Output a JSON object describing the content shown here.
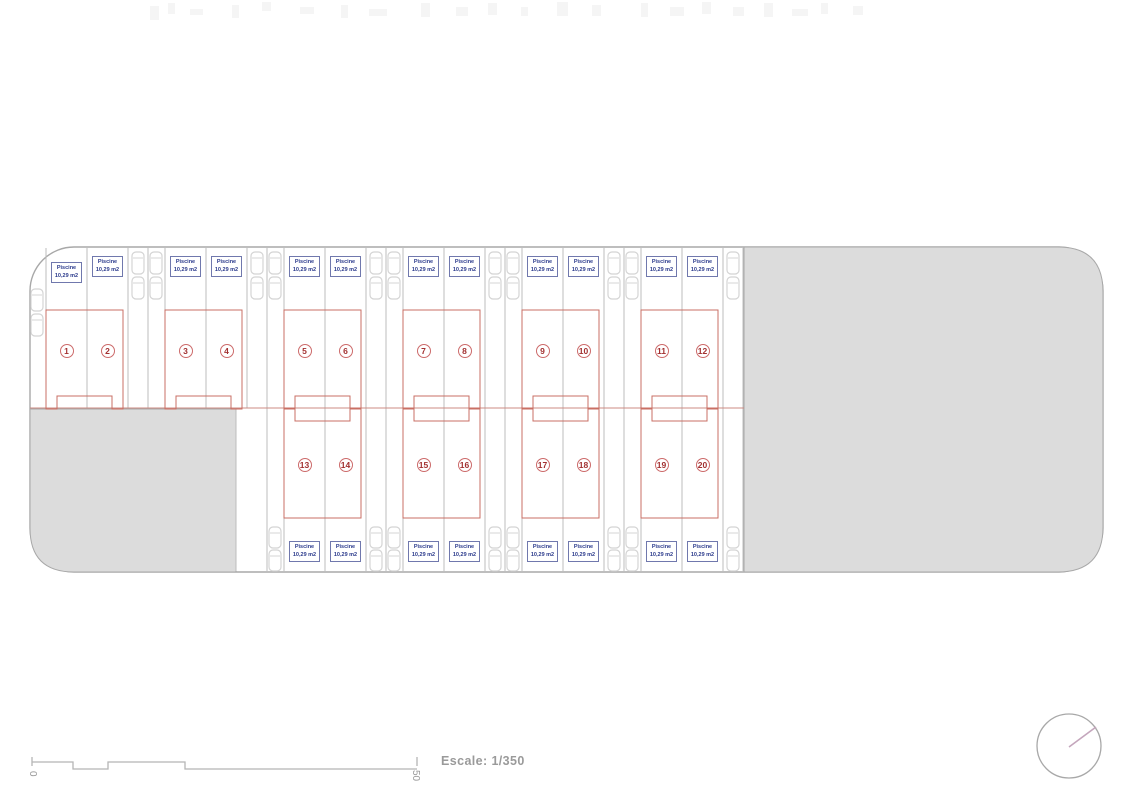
{
  "plan": {
    "unit_numbers": [
      "1",
      "2",
      "3",
      "4",
      "5",
      "6",
      "7",
      "8",
      "9",
      "10",
      "11",
      "12",
      "13",
      "14",
      "15",
      "16",
      "17",
      "18",
      "19",
      "20"
    ],
    "pool_label": {
      "line1": "Piscine",
      "line2": "10,29 m2"
    },
    "scale": {
      "text": "Escale: 1/350",
      "start_label": "0",
      "end_label": "50"
    },
    "colors": {
      "area_gray": "#dcdcdc",
      "outline_gray": "#a8a8a8",
      "lot_line_gray": "#bcbcbc",
      "building_red": "#c96f64",
      "fence_red": "#cc8b83",
      "badge_red": "#a23030",
      "badge_ring_red": "#cc6a6a",
      "pool_text_blue": "#2b3a8c",
      "pool_border_blue": "#7078ad",
      "car_gray": "#d4d4d4",
      "scalebar_gray": "#b5b5b5",
      "compass_needle_pink": "#c4a6bc",
      "artifact_gray": "#f5f5f5"
    }
  }
}
